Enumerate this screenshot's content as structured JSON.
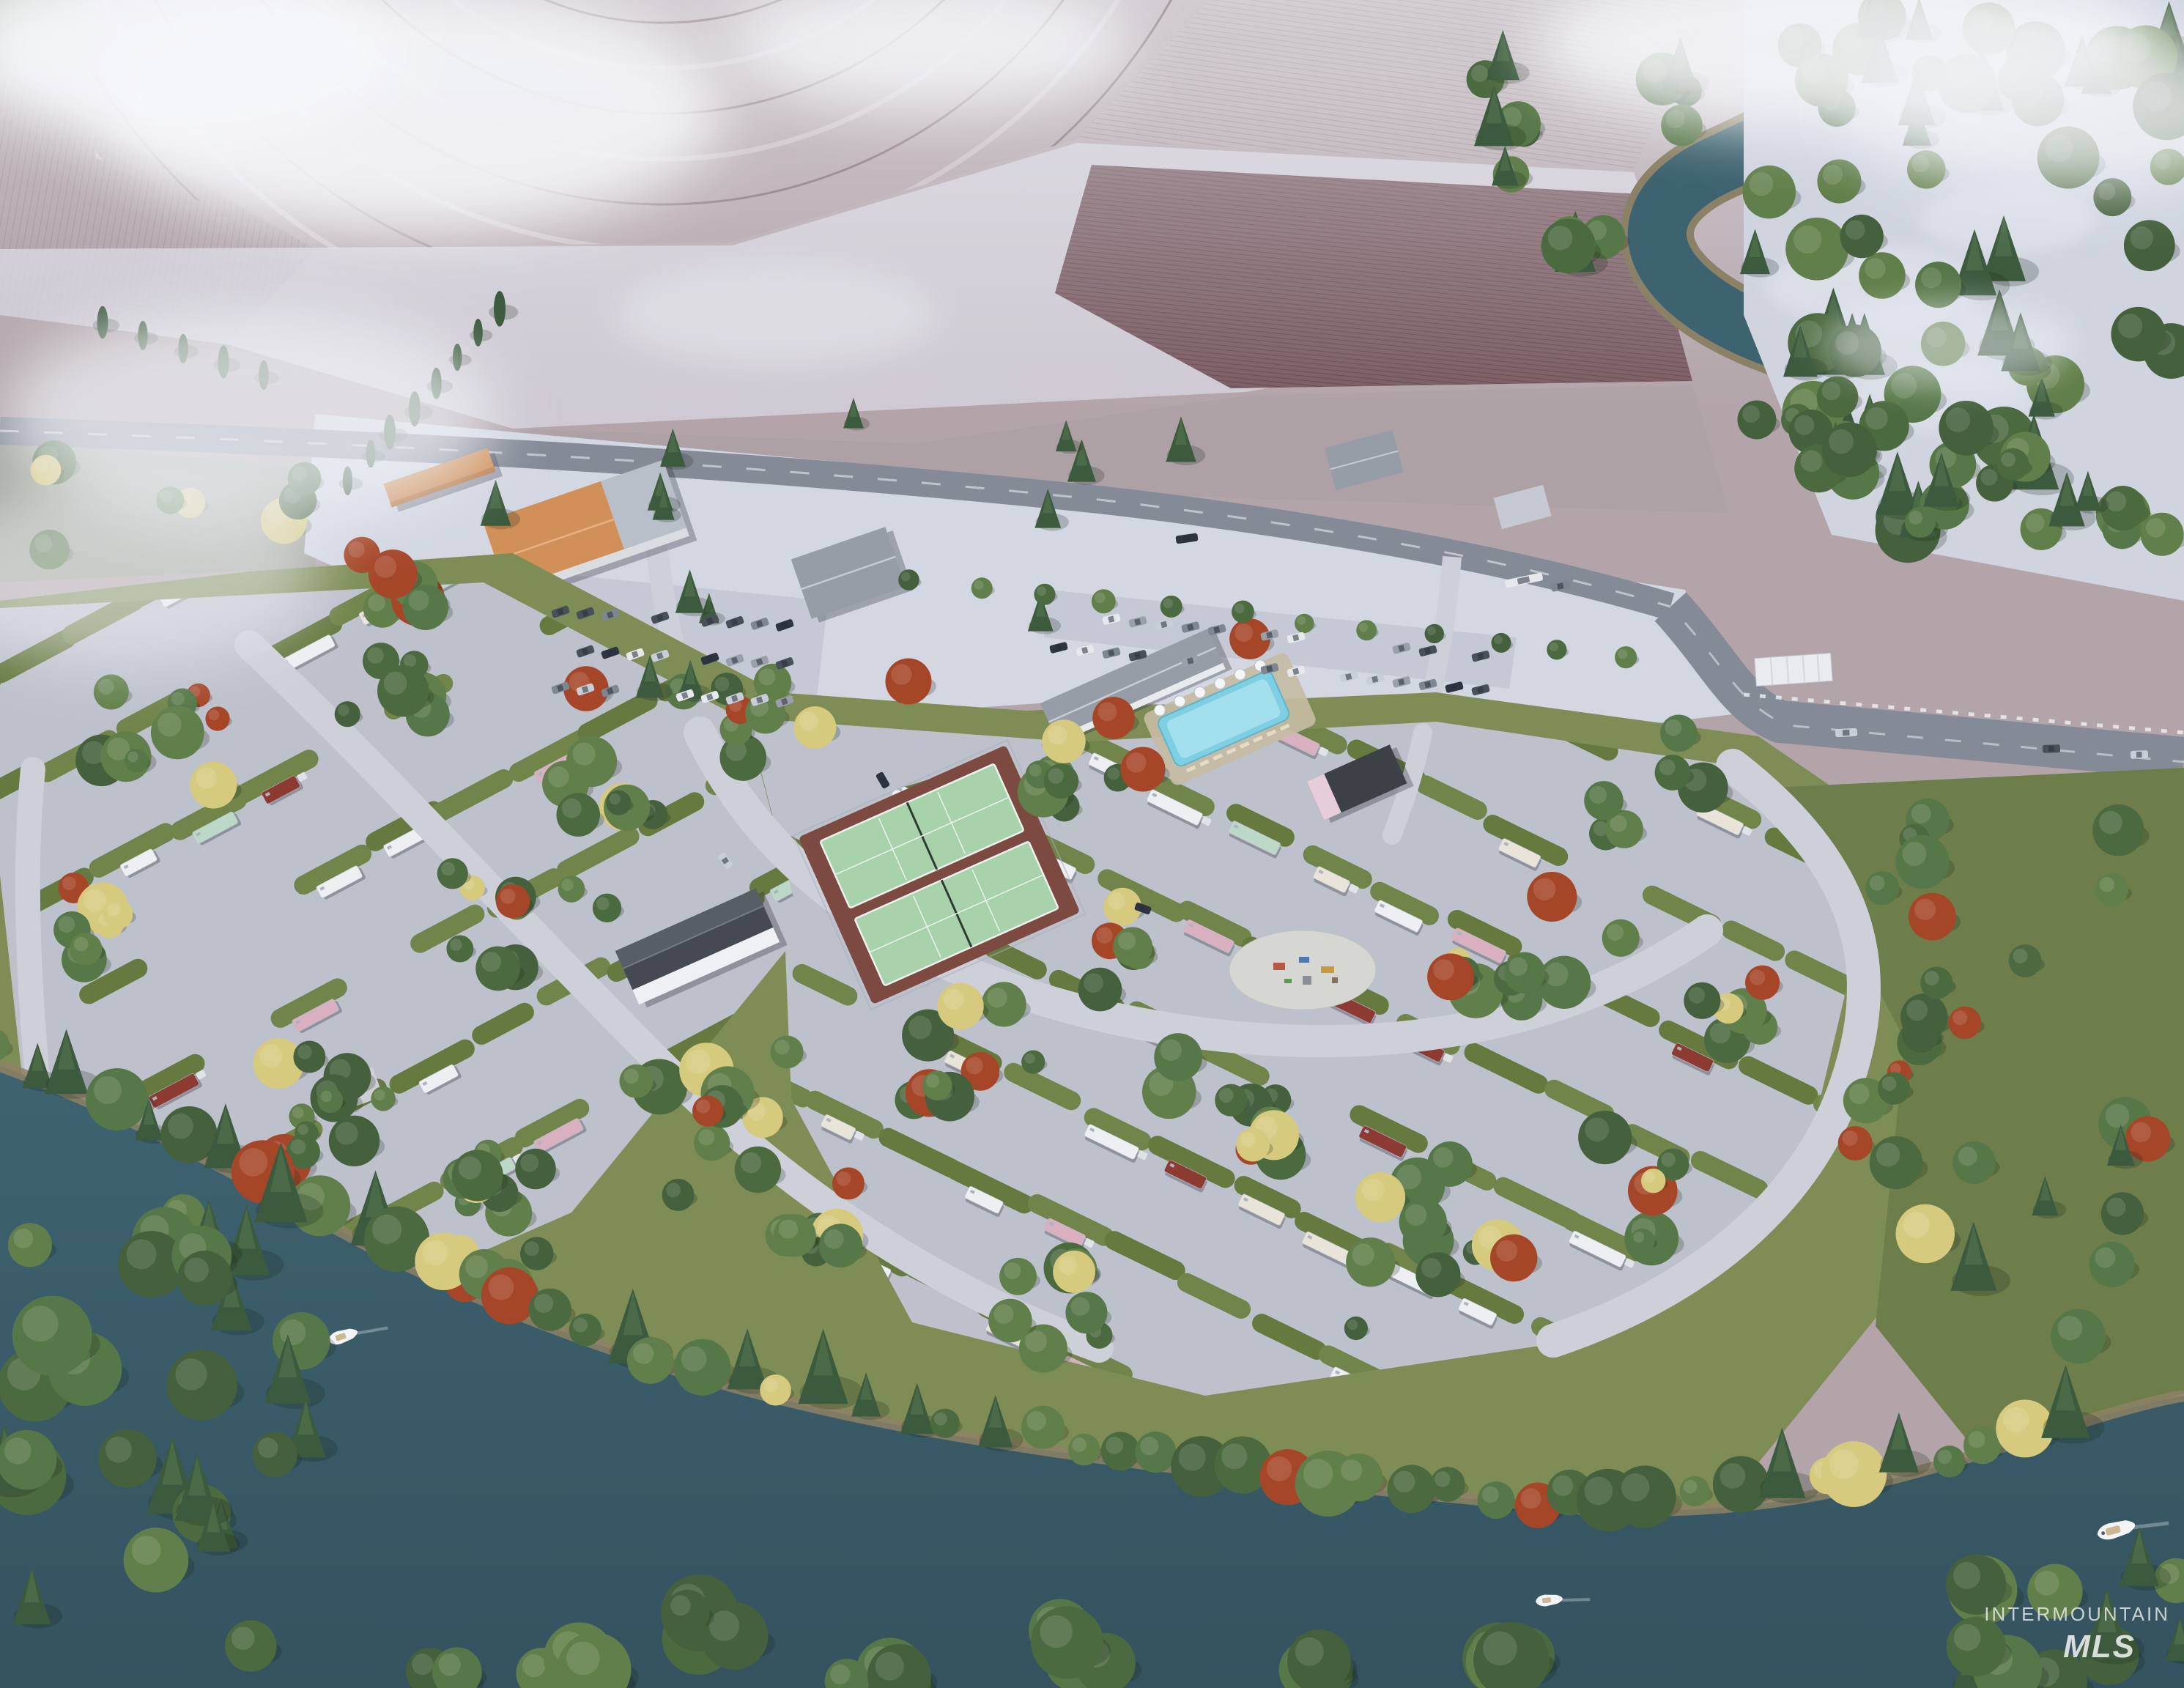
{
  "meta": {
    "title": "Aerial 3D rendering of a riverside RV resort campground in autumn with morning fog",
    "render_width": 2981,
    "render_height": 2304
  },
  "watermark": {
    "line1": "INTERMOUNTAIN",
    "line2": "MLS"
  },
  "palette": {
    "field_base": "#b2a4a9",
    "field_dark": "#7a5b62",
    "frost": "#d5d2dc",
    "snow_ground": "#d2d7e2",
    "forest_ground": "#cfd4df",
    "grass": "#7d8d55",
    "grass_dark": "#66793f",
    "lawn_east": "#6d7e4a",
    "asphalt": "#bdc1cc",
    "asphalt_light": "#cdd0d9",
    "road": "#848a96",
    "road_line": "#e8eaf0",
    "river": "#3e6370",
    "river_deep": "#35525f",
    "sand": "#8d8164",
    "tree_green": "#567747",
    "tree_light": "#7f9757",
    "tree_red": "#a64628",
    "tree_yellow": "#d6ca7e",
    "pine": "#3c5a3e",
    "forest_dark": "#44603c",
    "roof_orange": "#d29059",
    "roof_gray": "#969da7",
    "roof_dark": "#454a52",
    "wall_white": "#eef0f3",
    "pool_water": "#7fcfe2",
    "pool_deck": "#c6bca4",
    "court_green": "#a8d2aa",
    "court_base": "#7c4a41",
    "rv_white": "#edeff2",
    "boat_white": "#f2f4f6"
  },
  "scene": {
    "site_type": "rv-campsites",
    "amenities": [
      "swimming-pool",
      "clubhouse",
      "pickleball-courts",
      "bathhouse",
      "playground",
      "picnic-pavilion",
      "riverside-seating"
    ],
    "water": [
      "river",
      "side-channel"
    ],
    "environment": [
      "farm-fields",
      "center-pivot-field",
      "morning-fog",
      "forest",
      "autumn-trees",
      "frost-dusting",
      "highway",
      "parking-lots",
      "commercial-buildings"
    ],
    "counts": {
      "boats_visible": 3,
      "pickleball_courts": 2,
      "pools": 1
    }
  }
}
